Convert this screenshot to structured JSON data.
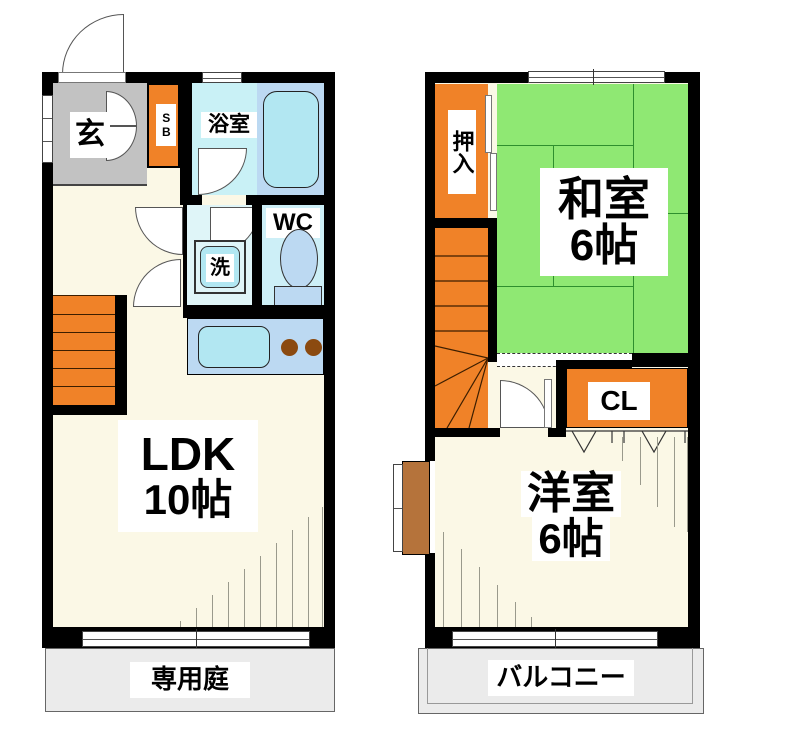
{
  "floor1": {
    "entrance": "玄",
    "shoe_box": "SB",
    "bathroom": "浴室",
    "toilet": "WC",
    "washer": "洗",
    "living": "LDK",
    "living_size": "10帖",
    "garden": "専用庭"
  },
  "floor2": {
    "oshiire": "押入",
    "japanese_room": "和室",
    "japanese_room_size": "6帖",
    "closet": "CL",
    "western_room": "洋室",
    "western_room_size": "6帖",
    "balcony": "バルコニー"
  },
  "colors": {
    "wall": "#000000",
    "room_floor": "#FBF8E6",
    "tatami_green": "#8FE873",
    "tatami_line": "#2E8F2E",
    "stairs_orange": "#F08228",
    "entrance_gray": "#C2C2C2",
    "bath_cyan": "#C9F1F6",
    "washroom_cyan": "#DFF5F8",
    "wc_cyan": "#CDEFF7",
    "fixture_blue": "#BCD9F2",
    "sink_cyan": "#B2E7F2",
    "outdoor_gray": "#EBEBEB",
    "burner_brown": "#8B4A10",
    "bay_window_brown": "#B5733B"
  }
}
